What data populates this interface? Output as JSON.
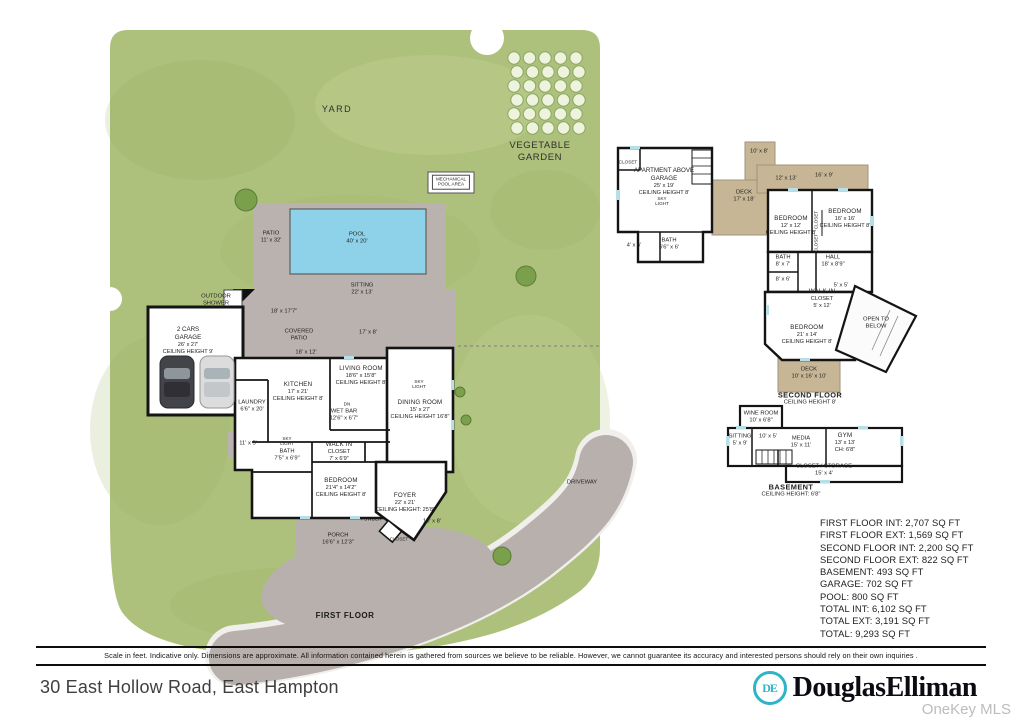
{
  "colors": {
    "yard_green": "#aec17c",
    "pool_blue": "#8ed2ea",
    "patio_gray": "#b9b2ae",
    "deck_tan": "#c7b695",
    "driveway_gray": "#b7b0ac",
    "wall_black": "#141414",
    "brand_teal": "#2fb4c7"
  },
  "plan": {
    "labels": [
      {
        "name": "yard-label",
        "x": 337,
        "y": 110,
        "cls": "area",
        "lines": [
          "YARD"
        ]
      },
      {
        "name": "vegetable-garden-label",
        "x": 540,
        "y": 152,
        "cls": "area2",
        "lines": [
          "VEGETABLE",
          "GARDEN"
        ]
      },
      {
        "name": "mechanical-pool-area-label",
        "x": 451,
        "y": 182,
        "cls": "boxed",
        "lines": [
          "MECHANICAL",
          "POOL AREA"
        ]
      },
      {
        "name": "patio-label",
        "x": 271,
        "y": 238,
        "cls": "dim2",
        "lines": [
          "PATIO",
          "11' x 32'"
        ]
      },
      {
        "name": "pool-label",
        "x": 357,
        "y": 239,
        "cls": "dim2",
        "lines": [
          "POOL",
          "40' x 20'"
        ]
      },
      {
        "name": "sitting-label",
        "x": 362,
        "y": 290,
        "cls": "dim2",
        "lines": [
          "SITTING",
          "22' x 13'"
        ]
      },
      {
        "name": "dim-18x177",
        "x": 284,
        "y": 312,
        "cls": "dim",
        "lines": [
          "18' x 17'7\""
        ]
      },
      {
        "name": "covered-patio-label",
        "x": 299,
        "y": 336,
        "cls": "dim2",
        "lines": [
          "COVERED",
          "PATIO"
        ]
      },
      {
        "name": "dim-17x8",
        "x": 368,
        "y": 333,
        "cls": "dim",
        "lines": [
          "17' x 8'"
        ]
      },
      {
        "name": "dim-18x12",
        "x": 306,
        "y": 353,
        "cls": "dim",
        "lines": [
          "18' x 12'"
        ]
      },
      {
        "name": "outdoor-shower-label",
        "x": 216,
        "y": 301,
        "cls": "dim2",
        "lines": [
          "OUTDOOR",
          "SHOWER"
        ]
      },
      {
        "name": "garage-label",
        "x": 188,
        "y": 341,
        "cls": "room4",
        "lines": [
          "2 CARS",
          "GARAGE",
          "26' x 27'",
          "CEILING HEIGHT 9'"
        ]
      },
      {
        "name": "kitchen-label",
        "x": 298,
        "y": 392,
        "cls": "room",
        "lines": [
          "KITCHEN",
          "17' x 21'",
          "CEILING HEIGHT 8'"
        ]
      },
      {
        "name": "living-room-label",
        "x": 361,
        "y": 376,
        "cls": "room",
        "lines": [
          "LIVING ROOM",
          "18'6\" x 15'8\"",
          "CEILING HEIGHT 8'"
        ]
      },
      {
        "name": "dn-label",
        "x": 347,
        "y": 404,
        "cls": "tiny",
        "lines": [
          "DN"
        ]
      },
      {
        "name": "wet-bar-label",
        "x": 344,
        "y": 416,
        "cls": "dim2",
        "lines": [
          "WET BAR",
          "12'6\" x 6'7\""
        ]
      },
      {
        "name": "dining-room-label",
        "x": 420,
        "y": 410,
        "cls": "room",
        "lines": [
          "DINING ROOM",
          "15' x 27'",
          "CEILING HEIGHT 16'8\""
        ]
      },
      {
        "name": "sky-light-dining-label",
        "x": 419,
        "y": 384,
        "cls": "tiny",
        "lines": [
          "SKY",
          "LIGHT"
        ]
      },
      {
        "name": "laundry-label",
        "x": 252,
        "y": 407,
        "cls": "dim2",
        "lines": [
          "LAUNDRY",
          "6'6\" x 20'"
        ]
      },
      {
        "name": "walk-in-closet-first-label",
        "x": 339,
        "y": 452,
        "cls": "room",
        "lines": [
          "WALK IN",
          "CLOSET",
          "7' x 6'9\""
        ]
      },
      {
        "name": "bath-first-label",
        "x": 287,
        "y": 456,
        "cls": "dim2",
        "lines": [
          "BATH",
          "7'5\" x 6'9\""
        ]
      },
      {
        "name": "sky-light-bath-label",
        "x": 287,
        "y": 441,
        "cls": "tiny",
        "lines": [
          "SKY",
          "LIGHT"
        ]
      },
      {
        "name": "bedroom-first-label",
        "x": 341,
        "y": 488,
        "cls": "room",
        "lines": [
          "BEDROOM",
          "21'4\" x 14'2\"",
          "CEILING HEIGHT 8'"
        ]
      },
      {
        "name": "foyer-label",
        "x": 405,
        "y": 503,
        "cls": "room",
        "lines": [
          "FOYER",
          "22' x 21'",
          "CEILING HEIGHT: 25'8\""
        ]
      },
      {
        "name": "powder-label",
        "x": 371,
        "y": 519,
        "cls": "tiny",
        "lines": [
          "POWDER"
        ]
      },
      {
        "name": "closet-foyer-label",
        "x": 399,
        "y": 539,
        "cls": "tiny",
        "lines": [
          "CLOSET"
        ]
      },
      {
        "name": "dim-10x8-entry",
        "x": 432,
        "y": 522,
        "cls": "dim",
        "lines": [
          "10' x 8'"
        ]
      },
      {
        "name": "porch-label",
        "x": 338,
        "y": 540,
        "cls": "dim2",
        "lines": [
          "PORCH",
          "16'6\" x 12'3\""
        ]
      },
      {
        "name": "dim-11x5",
        "x": 248,
        "y": 444,
        "cls": "dim",
        "lines": [
          "11' x 5'"
        ]
      },
      {
        "name": "driveway-label",
        "x": 582,
        "y": 483,
        "cls": "dim",
        "lines": [
          "DRIVEWAY"
        ]
      },
      {
        "name": "first-floor-title",
        "x": 345,
        "y": 616,
        "cls": "title",
        "lines": [
          "FIRST FLOOR"
        ]
      },
      {
        "name": "closet-apartment-label",
        "x": 628,
        "y": 162,
        "cls": "tiny",
        "lines": [
          "CLOSET"
        ]
      },
      {
        "name": "apartment-above-garage-label",
        "x": 664,
        "y": 182,
        "cls": "room4",
        "lines": [
          "APARTMENT ABOVE",
          "GARAGE",
          "25' x 19'",
          "CEILING HEIGHT 8'"
        ]
      },
      {
        "name": "sky-light-apartment-label",
        "x": 662,
        "y": 201,
        "cls": "tiny",
        "lines": [
          "SKY",
          "LIGHT"
        ]
      },
      {
        "name": "deck-upper-label",
        "x": 744,
        "y": 197,
        "cls": "dim2",
        "lines": [
          "DECK",
          "17' x 18'"
        ]
      },
      {
        "name": "dim-10x8-deck",
        "x": 759,
        "y": 152,
        "cls": "dim",
        "lines": [
          "10' x 8'"
        ]
      },
      {
        "name": "bath-apartment-label",
        "x": 669,
        "y": 245,
        "cls": "dim2",
        "lines": [
          "BATH",
          "6'6\" x 6'"
        ]
      },
      {
        "name": "dim-4x6",
        "x": 634,
        "y": 246,
        "cls": "dim",
        "lines": [
          "4' x 6'"
        ]
      },
      {
        "name": "dim-12x13",
        "x": 786,
        "y": 179,
        "cls": "dim",
        "lines": [
          "12' x 13'"
        ]
      },
      {
        "name": "dim-16x9",
        "x": 824,
        "y": 176,
        "cls": "dim",
        "lines": [
          "16' x 9'"
        ]
      },
      {
        "name": "bedroom-12-label",
        "x": 791,
        "y": 226,
        "cls": "room",
        "lines": [
          "BEDROOM",
          "12' x 12'",
          "CEILING HEIGHT 8'"
        ]
      },
      {
        "name": "closet-a-label",
        "x": 816,
        "y": 220,
        "cls": "tinyV",
        "lines": [
          "CLOSET"
        ]
      },
      {
        "name": "closet-b-label",
        "x": 816,
        "y": 243,
        "cls": "tinyV",
        "lines": [
          "CLOSET"
        ]
      },
      {
        "name": "bedroom-16-label",
        "x": 845,
        "y": 219,
        "cls": "room",
        "lines": [
          "BEDROOM",
          "16' x 16'",
          "CEILING HEIGHT 8'"
        ]
      },
      {
        "name": "hall-label",
        "x": 833,
        "y": 262,
        "cls": "dim2",
        "lines": [
          "HALL",
          "18' x 8'9\""
        ]
      },
      {
        "name": "bath-second-label",
        "x": 783,
        "y": 262,
        "cls": "dim2",
        "lines": [
          "BATH",
          "8' x 7'"
        ]
      },
      {
        "name": "dim-8x6",
        "x": 783,
        "y": 280,
        "cls": "dim",
        "lines": [
          "8' x 6'"
        ]
      },
      {
        "name": "walk-in-closet-second-label",
        "x": 822,
        "y": 299,
        "cls": "room",
        "lines": [
          "WALK IN",
          "CLOSET",
          "5' x 12'"
        ]
      },
      {
        "name": "dim-5x5",
        "x": 841,
        "y": 286,
        "cls": "dim",
        "lines": [
          "5' x 5'"
        ]
      },
      {
        "name": "open-to-below-label",
        "x": 876,
        "y": 324,
        "cls": "dim2",
        "lines": [
          "OPEN TO",
          "BELOW"
        ]
      },
      {
        "name": "bedroom-21-label",
        "x": 807,
        "y": 335,
        "cls": "room",
        "lines": [
          "BEDROOM",
          "21' x 14'",
          "CEILING HEIGHT 8'"
        ]
      },
      {
        "name": "deck-lower-label",
        "x": 809,
        "y": 374,
        "cls": "dim2",
        "lines": [
          "DECK",
          "10' x 16' x 10'"
        ]
      },
      {
        "name": "second-floor-title",
        "x": 810,
        "y": 399,
        "cls": "title2",
        "lines": [
          "SECOND FLOOR",
          "CEILING HEIGHT 8'"
        ]
      },
      {
        "name": "wine-room-label",
        "x": 761,
        "y": 418,
        "cls": "dim2",
        "lines": [
          "WINE ROOM",
          "10' x 6'8\""
        ]
      },
      {
        "name": "sitting-basement-label",
        "x": 740,
        "y": 441,
        "cls": "dim2",
        "lines": [
          "SITTING",
          "5' x 9'"
        ]
      },
      {
        "name": "dim-10x5",
        "x": 768,
        "y": 437,
        "cls": "dim",
        "lines": [
          "10' x 5'"
        ]
      },
      {
        "name": "media-label",
        "x": 801,
        "y": 443,
        "cls": "dim2",
        "lines": [
          "MEDIA",
          "15' x 11'"
        ]
      },
      {
        "name": "gym-label",
        "x": 845,
        "y": 443,
        "cls": "room",
        "lines": [
          "GYM",
          "13' x 13'",
          "CH: 6'8\""
        ]
      },
      {
        "name": "closet-storage-label",
        "x": 824,
        "y": 471,
        "cls": "dim2",
        "lines": [
          "CLOSET / STORAGE",
          "15' x 4'"
        ]
      },
      {
        "name": "basement-title",
        "x": 791,
        "y": 491,
        "cls": "title2",
        "lines": [
          "BASEMENT",
          "CEILING HEIGHT: 6'8\""
        ]
      }
    ]
  },
  "sqft": {
    "lines": [
      "FIRST FLOOR INT: 2,707 SQ FT",
      "FIRST FLOOR EXT: 1,569 SQ FT",
      "SECOND FLOOR INT: 2,200 SQ FT",
      "SECOND FLOOR EXT: 822 SQ FT",
      "BASEMENT: 493 SQ FT",
      "GARAGE: 702 SQ FT",
      "POOL: 800 SQ FT",
      "TOTAL INT: 6,102 SQ FT",
      "TOTAL EXT: 3,191 SQ FT",
      "TOTAL: 9,293 SQ FT"
    ]
  },
  "footer": {
    "disclaimer": "Scale in feet. Indicative only. Dimensions are approximate. All information contained herein is gathered from sources we believe to be reliable. However, we cannot guarantee its accuracy and interested persons should rely on their own inquiries .",
    "address": "30 East Hollow Road, East Hampton"
  },
  "brand": {
    "wordmark": "DouglasElliman",
    "monogram": "DE"
  },
  "watermark": "OneKey MLS"
}
